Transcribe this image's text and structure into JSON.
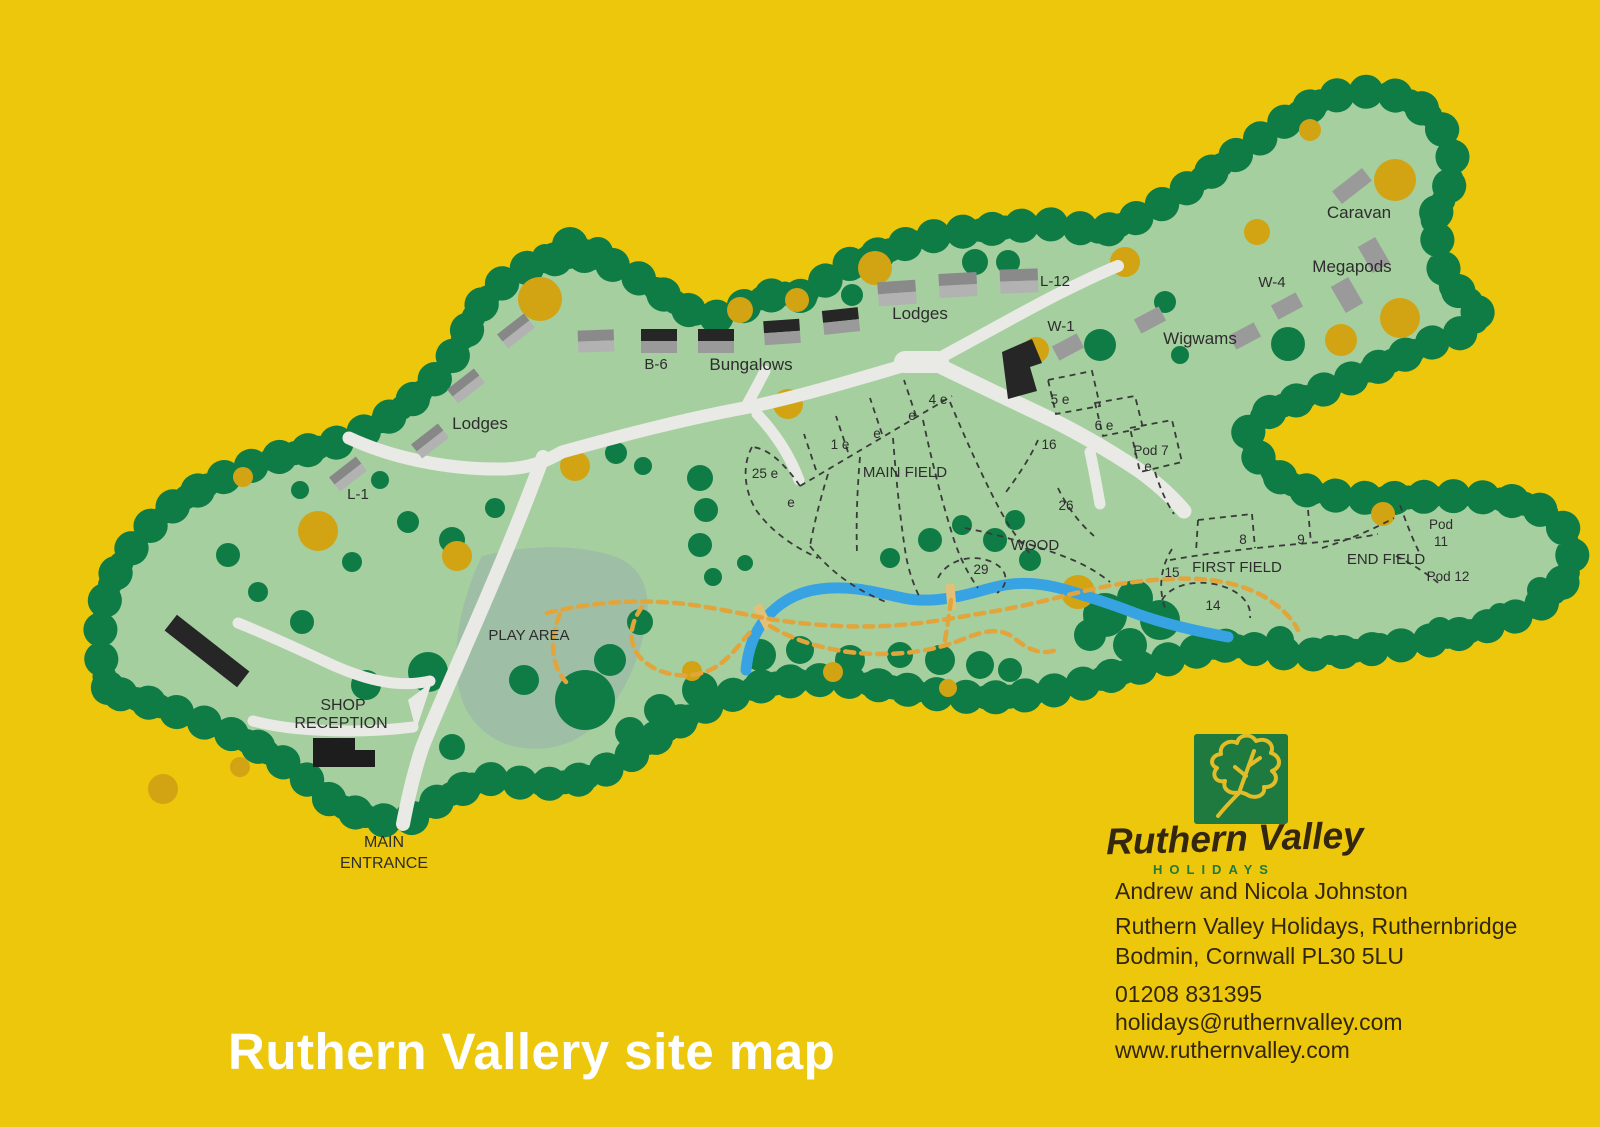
{
  "title": "Ruthern Vallery site map",
  "brand": {
    "name": "Ruthern Valley",
    "tagline": "HOLIDAYS"
  },
  "contact": {
    "owners": "Andrew and Nicola Johnston",
    "address1": "Ruthern Valley Holidays, Ruthernbridge",
    "address2": "Bodmin, Cornwall PL30 5LU",
    "phone": "01208 831395",
    "email": "holidays@ruthernvalley.com",
    "website": "www.ruthernvalley.com"
  },
  "colors": {
    "background": "#edc70b",
    "land": "#a5cf9f",
    "trees": "#0e7c44",
    "autumn_trees": "#d2a413",
    "roads": "#e9e9e6",
    "river": "#38a3e3",
    "trails": "#e2a53b",
    "play_area": "#9fbea6",
    "plot_lines": "#3a3a3a",
    "bridge": "#e3c078",
    "logo_green": "#1e7a3e",
    "leaf_yellow": "#e3bd27"
  },
  "map": {
    "labels": [
      {
        "text": "Caravan",
        "x": 1359,
        "y": 218,
        "size": 17
      },
      {
        "text": "Megapods",
        "x": 1352,
        "y": 272,
        "size": 17
      },
      {
        "text": "W-4",
        "x": 1272,
        "y": 287,
        "size": 15
      },
      {
        "text": "Wigwams",
        "x": 1200,
        "y": 344,
        "size": 17
      },
      {
        "text": "W-1",
        "x": 1061,
        "y": 331,
        "size": 15
      },
      {
        "text": "L-12",
        "x": 1055,
        "y": 286,
        "size": 15
      },
      {
        "text": "Lodges",
        "x": 920,
        "y": 319,
        "size": 17
      },
      {
        "text": "Bungalows",
        "x": 751,
        "y": 370,
        "size": 17
      },
      {
        "text": "B-6",
        "x": 656,
        "y": 369,
        "size": 15
      },
      {
        "text": "Lodges",
        "x": 480,
        "y": 429,
        "size": 17
      },
      {
        "text": "L-1",
        "x": 358,
        "y": 499,
        "size": 15
      },
      {
        "text": "1 e",
        "x": 840,
        "y": 449,
        "size": 13.5
      },
      {
        "text": "e",
        "x": 877,
        "y": 438,
        "size": 13.5
      },
      {
        "text": "e",
        "x": 912,
        "y": 420,
        "size": 13.5
      },
      {
        "text": "4 e",
        "x": 938,
        "y": 404,
        "size": 13.5
      },
      {
        "text": "25 e",
        "x": 765,
        "y": 478,
        "size": 13.5
      },
      {
        "text": "e",
        "x": 791,
        "y": 507,
        "size": 13.5
      },
      {
        "text": "MAIN FIELD",
        "x": 905,
        "y": 477,
        "size": 15
      },
      {
        "text": "5 e",
        "x": 1060,
        "y": 404,
        "size": 13.5
      },
      {
        "text": "6 e",
        "x": 1104,
        "y": 430,
        "size": 13.5
      },
      {
        "text": "16",
        "x": 1049,
        "y": 449,
        "size": 13.5
      },
      {
        "text": "Pod 7",
        "x": 1151,
        "y": 455,
        "size": 13.5
      },
      {
        "text": "e",
        "x": 1148,
        "y": 471,
        "size": 13.5
      },
      {
        "text": "26",
        "x": 1066,
        "y": 510,
        "size": 13.5
      },
      {
        "text": "WOOD",
        "x": 1035,
        "y": 550,
        "size": 15
      },
      {
        "text": "29",
        "x": 981,
        "y": 574,
        "size": 13.5
      },
      {
        "text": "8",
        "x": 1243,
        "y": 544,
        "size": 13.5
      },
      {
        "text": "9",
        "x": 1301,
        "y": 544,
        "size": 13.5
      },
      {
        "text": "FIRST FIELD",
        "x": 1237,
        "y": 572,
        "size": 15
      },
      {
        "text": "15",
        "x": 1172,
        "y": 577,
        "size": 13.5
      },
      {
        "text": "14",
        "x": 1213,
        "y": 610,
        "size": 13.5
      },
      {
        "text": "END FIELD",
        "x": 1386,
        "y": 564,
        "size": 15
      },
      {
        "text": "Pod",
        "x": 1441,
        "y": 529,
        "size": 13.5
      },
      {
        "text": "11",
        "x": 1441,
        "y": 546,
        "size": 13.5
      },
      {
        "text": "Pod 12",
        "x": 1448,
        "y": 581,
        "size": 13.5,
        "color": "#ffffff"
      },
      {
        "text": "PLAY AREA",
        "x": 529,
        "y": 640,
        "size": 15
      },
      {
        "text": "SHOP",
        "x": 343,
        "y": 710,
        "size": 16
      },
      {
        "text": "RECEPTION",
        "x": 341,
        "y": 728,
        "size": 16
      },
      {
        "text": "MAIN",
        "x": 384,
        "y": 847,
        "size": 16
      },
      {
        "text": "ENTRANCE",
        "x": 384,
        "y": 868,
        "size": 16
      }
    ]
  }
}
